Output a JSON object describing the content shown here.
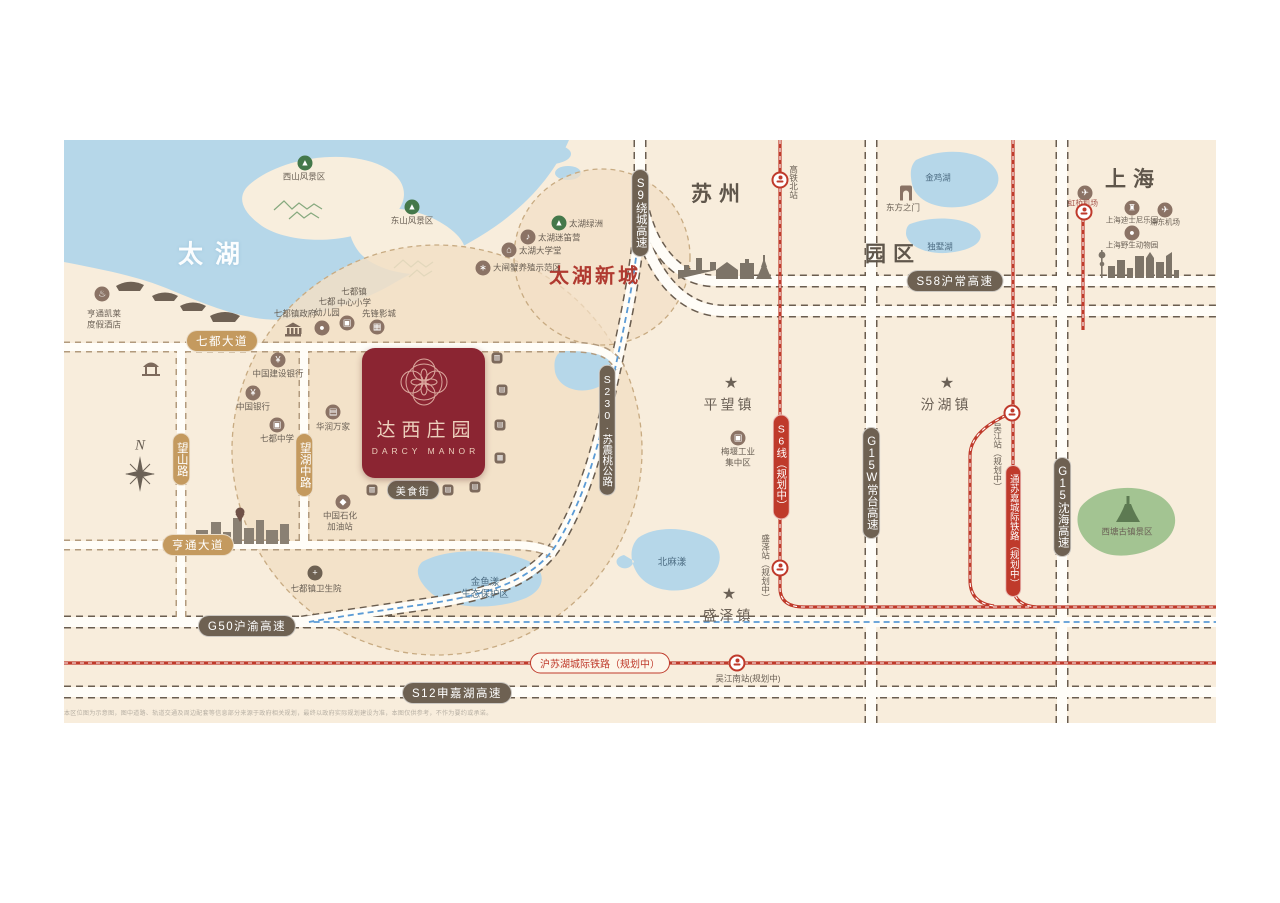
{
  "logo": {
    "cn": "达西庄园",
    "en": "DARCY MANOR"
  },
  "regions": {
    "taihu": "太湖",
    "suzhou": "苏州",
    "parkzone": "园区",
    "shanghai": "上海",
    "taihu_new_town": "太湖新城"
  },
  "compass": {
    "north": "N"
  },
  "towns": {
    "pingwang": "平望镇",
    "fenhu": "汾湖镇",
    "shengze": "盛泽镇"
  },
  "roads": {
    "qidu_avenue": "七都大道",
    "wangshan_road": "望山路",
    "wanghu_middle_road": "望湖中路",
    "hengtong_avenue": "亨通大道",
    "g50": "G50沪渝高速",
    "s12": "S12申嘉湖高速",
    "s58": "S58沪常高速",
    "s9": "S9绕城高速",
    "g15w": "G15W常台高速",
    "g15": "G15沈海高速",
    "s230": "S230·苏震桃公路"
  },
  "railways": {
    "s6": "S6线（规划中）",
    "tongsujia": "通苏嘉城际铁路（规划中）",
    "husuhu": "沪苏湖城际铁路（规划中）"
  },
  "stations": {
    "gaotie_north": "高铁北站",
    "shengze": "盛泽站（规划中）",
    "wujiang": "吴江站（规划中）",
    "wujiang_south": "吴江南站(规划中)"
  },
  "scenic": {
    "xishan": "西山风景区",
    "dongshan": "东山风景区",
    "xitang": "西塘古镇景区",
    "jinyuyang": [
      "金鱼漾",
      "生态保护区"
    ]
  },
  "lakes": {
    "jinji": "金鸡湖",
    "dushu": "独墅湖",
    "beimayang": "北麻漾"
  },
  "pois": {
    "hotel": [
      "亨通凯莱",
      "度假酒店"
    ],
    "gov": "七都镇政府",
    "kindergarten": [
      "七都",
      "幼儿园"
    ],
    "primary": [
      "七都镇",
      "中心小学"
    ],
    "cinema": "先锋影城",
    "ccb": "中国建设银行",
    "boc": "中国银行",
    "middle_school": "七都中学",
    "vanguard": "华润万家",
    "sinopec": [
      "中国石化",
      "加油站"
    ],
    "hospital": "七都镇卫生院",
    "meiyan": [
      "梅堰工业",
      "集中区"
    ],
    "gate_of_orient": "东方之门",
    "hongqiao_airport": "虹桥机场",
    "disney": "上海迪士尼乐园",
    "pudong_airport": "浦东机场",
    "wildlife_park": "上海野生动物园",
    "taihu_oasis": "太湖绿洲",
    "midi_camp": "太湖迷笛营",
    "taihu_university": "太湖大学堂",
    "crab_zone": "大闸蟹养殖示范区",
    "food_street": "美食街"
  },
  "icons": {
    "star": "★",
    "plane": "✈",
    "mountain": "▲",
    "bank": "¥",
    "school": "▣",
    "cinema": "▦",
    "market": "▤",
    "gas": "◆",
    "hospital": "+",
    "hotel": "♨",
    "factory": "▣",
    "castle": "♜",
    "animal": "●",
    "music": "♪",
    "house": "⌂",
    "crab": "∗",
    "kid": "●",
    "shop": "▥",
    "food": "▤",
    "dot": "●"
  },
  "colors": {
    "brand_red": "#8b2532",
    "rail_red": "#bf3a2b",
    "gold": "#c49a5f",
    "olive": "#6e6152",
    "water": "#b6d7e9",
    "bg": "#f8eddc",
    "boundary_blue": "#5b9bd5"
  },
  "disclaimer": "本区位图为示意图，图中道路、轨道交通及周边配套等信息部分来源于政府相关规划，最终以政府实际规划建设为准，本图仅供参考，不作为要约或承诺。"
}
